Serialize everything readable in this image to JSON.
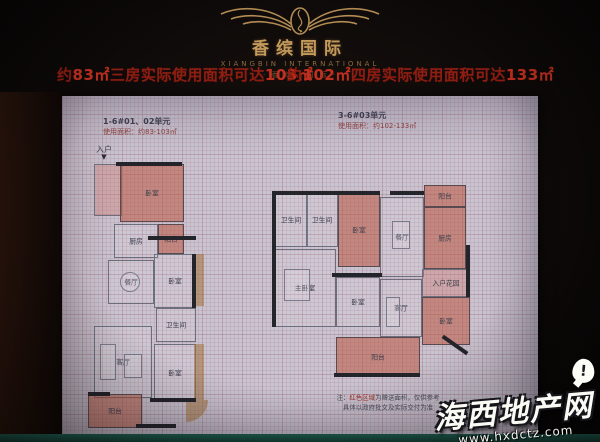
{
  "brand": {
    "name": "香缤国际",
    "subtitle": "XIANGBIN INTERNATIONAL",
    "tagline": "· 香 缤 · 国 际 ·"
  },
  "headlines": {
    "left": {
      "t1": "约",
      "n1": "83㎡",
      "t2": "三房实际使用面积可达",
      "n2": "103㎡"
    },
    "right": {
      "t1": "约",
      "n1": "102㎡",
      "t2": "四房实际使用面积可达",
      "n2": "133㎡"
    }
  },
  "plans": {
    "left": {
      "unit": "1-6#01、02单元",
      "area_note": "使用面积：约83-103㎡",
      "entry": "入户",
      "entry_arrow": "▼",
      "rooms": [
        {
          "label": "卧室"
        },
        {
          "label": "厨房"
        },
        {
          "label": "阳台"
        },
        {
          "label": "餐厅"
        },
        {
          "label": "卧室"
        },
        {
          "label": "卫生间"
        },
        {
          "label": "客厅"
        },
        {
          "label": "卧室"
        },
        {
          "label": "阳台"
        }
      ]
    },
    "right": {
      "unit": "3-6#03单元",
      "area_note": "使用面积：约102-133㎡",
      "rooms": [
        {
          "label": "卫生间"
        },
        {
          "label": "卫生间"
        },
        {
          "label": "卧室"
        },
        {
          "label": "餐厅"
        },
        {
          "label": "阳台"
        },
        {
          "label": "厨房"
        },
        {
          "label": "入户花园"
        },
        {
          "label": "主卧室"
        },
        {
          "label": "卧室"
        },
        {
          "label": "客厅"
        },
        {
          "label": "卧室"
        },
        {
          "label": "阳台"
        }
      ]
    }
  },
  "note": {
    "line1_pre": "注：",
    "line1_red": "红色区域",
    "line1_post": "为赠送面积，仅供参考",
    "line2": "具体以政府批文及实际交付为准"
  },
  "watermark": {
    "site": "海西地产网",
    "url": "www.hxdctz.com",
    "alert": "!"
  },
  "colors": {
    "accent_red": "#8e1d12",
    "bright_red": "#c0301f",
    "gold": "#c49a5c",
    "panel_bg": "#c8c5d1",
    "highlight_room": "#b9553e",
    "teal_strip": "#1f5a4c"
  }
}
